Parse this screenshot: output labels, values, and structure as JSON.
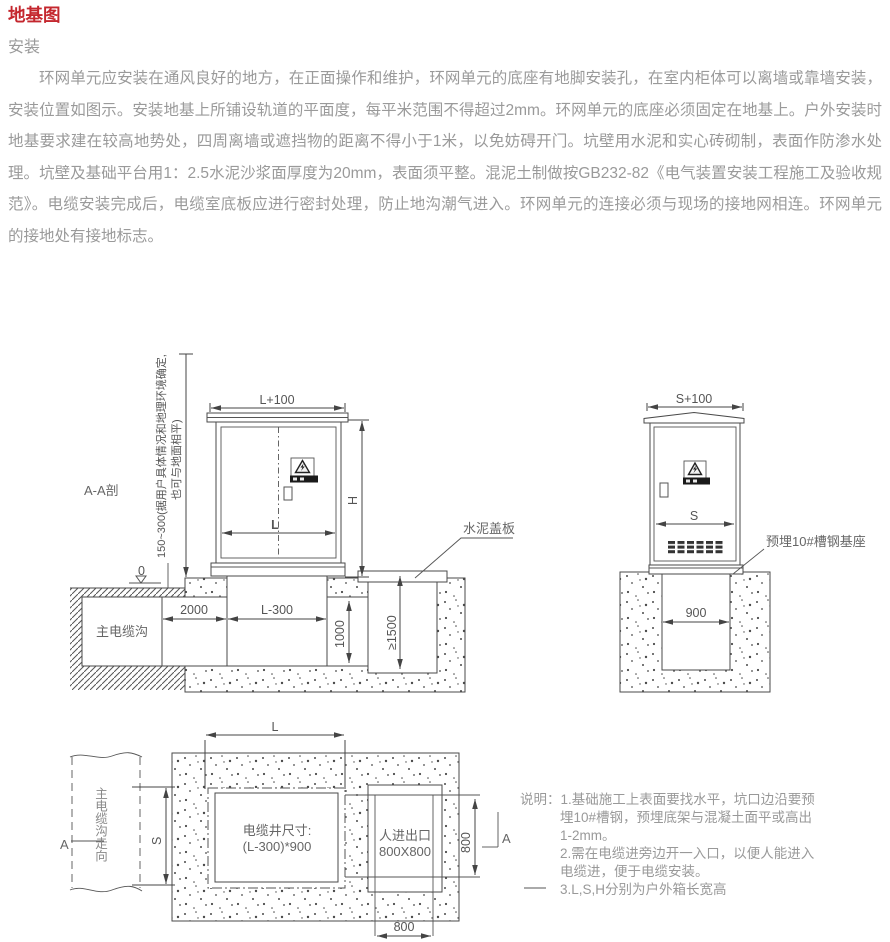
{
  "page": {
    "title": "地基图",
    "subtitle": "安装",
    "paragraph": "环网单元应安装在通风良好的地方，在正面操作和维护，环网单元的底座有地脚安装孔，在室内柜体可以离墙或靠墙安装，安装位置如图示。安装地基上所铺设轨道的平面度，每平米范围不得超过2mm。环网单元的底座必须固定在地基上。户外安装时地基要求建在较高地势处，四周离墙或遮挡物的距离不得小于1米，以免妨碍开门。坑壁用水泥和实心砖砌制，表面作防渗水处理。坑壁及基础平台用1：2.5水泥沙浆面厚度为20mm，表面须平整。混泥土制做按GB232-82《电气装置安装工程施工及验收规范》。电缆安装完成后，电缆室底板应进行密封处理，防止地沟潮气进入。环网单元的连接必须与现场的接地网相连。环网单元的接地处有接地标志。"
  },
  "front": {
    "section_label": "A-A剖",
    "depth_note1": "150~300(据用户具体情况和地理环境确定,",
    "depth_note2": "也可与地面相平)",
    "level_zero": "0",
    "dim_top": "L+100",
    "dim_h": "H",
    "dim_l": "L",
    "trench": "主电缆沟",
    "dim_2000": "2000",
    "dim_l300": "L-300",
    "dim_1000": "1000",
    "dim_1500": "≥1500",
    "cover": "水泥盖板"
  },
  "side": {
    "dim_top": "S+100",
    "dim_s": "S",
    "dim_900": "900",
    "base_label": "预埋10#槽钢基座"
  },
  "plan": {
    "dim_l": "L",
    "dim_s": "S",
    "trench": "主电缆沟走向",
    "well_line1": "电缆井尺寸:",
    "well_line2": "(L-300)*900",
    "entrance_line1": "人进出口",
    "entrance_line2": "800X800",
    "dim_800v": "800",
    "dim_800h": "800",
    "a_left": "A",
    "a_right": "A"
  },
  "notes": {
    "lines": [
      "说明：1.基础施工上表面要找水平，坑口边沿要预",
      "埋10#槽钢，预埋底架与混凝土面平或高出",
      "1-2mm。",
      "2.需在电缆进旁边开一入口，以便人能进入",
      "电缆进，便于电缆安装。",
      "3.L,S,H分别为户外箱长宽高"
    ]
  },
  "colors": {
    "title_red": "#c4272e",
    "body_text": "#9a9a9a",
    "line": "#4a4a4a"
  }
}
